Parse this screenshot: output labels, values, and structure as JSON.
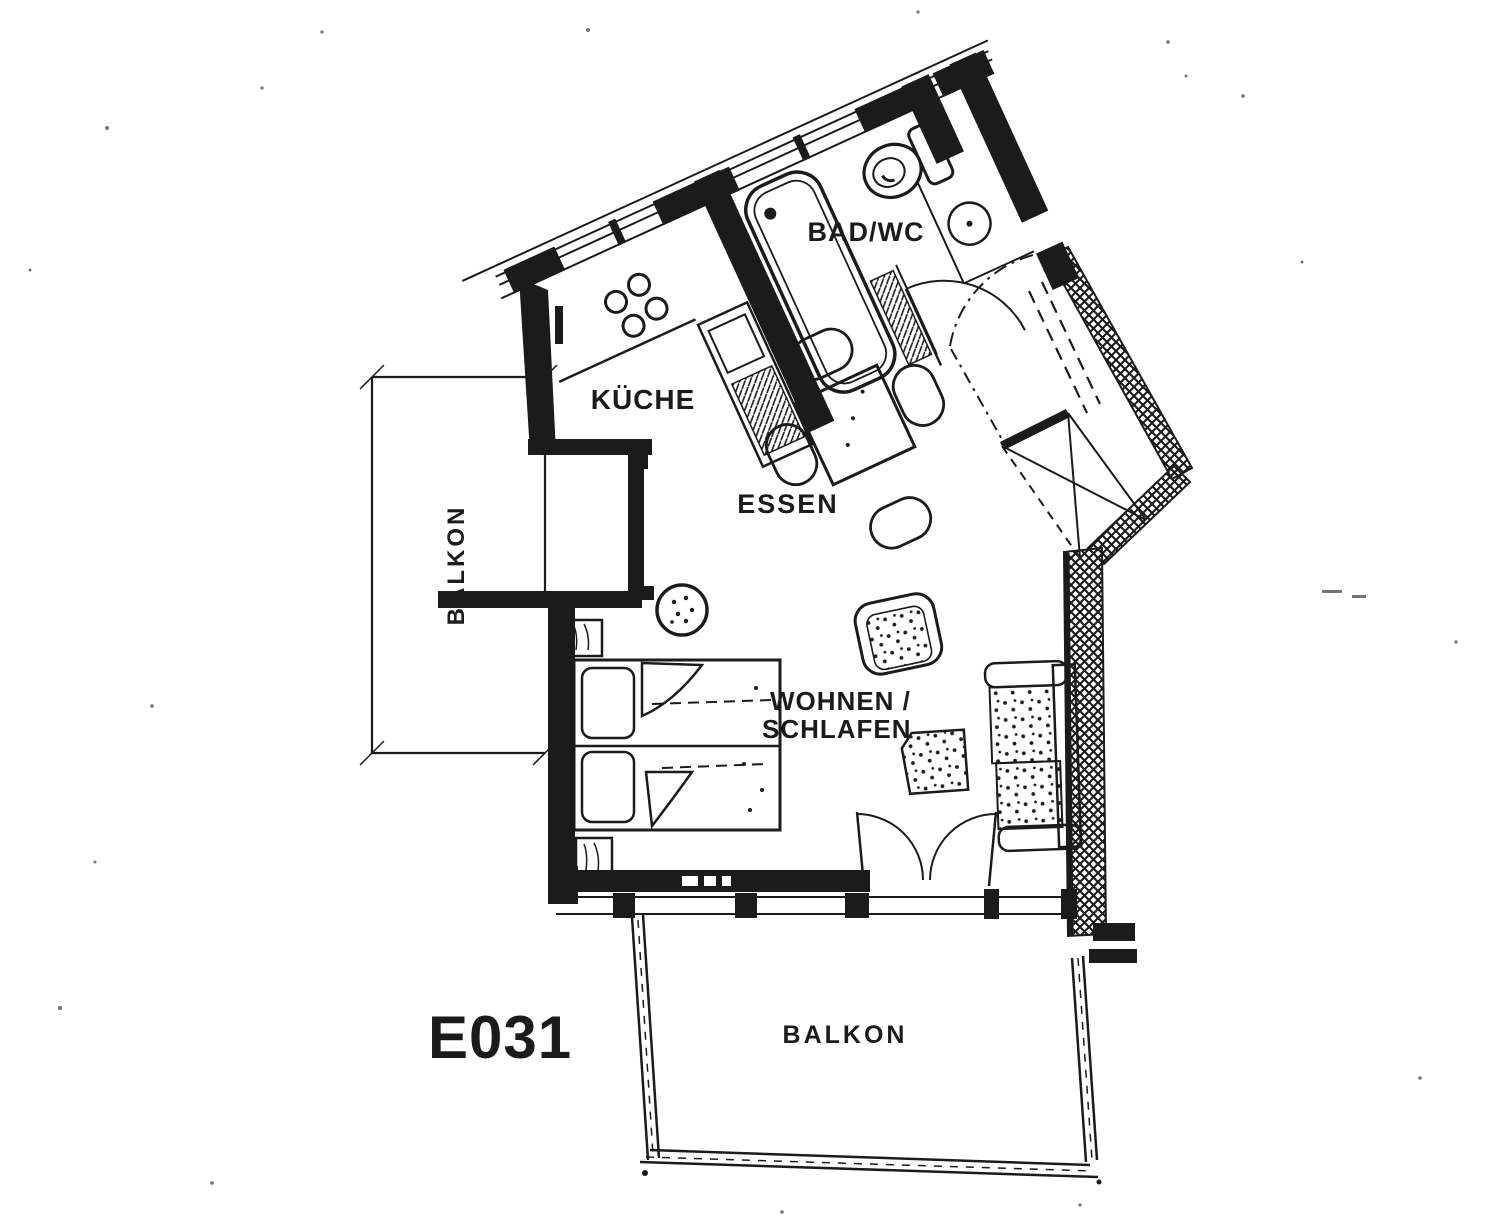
{
  "document": {
    "type": "scanned apartment floor plan",
    "unit_label": "E031"
  },
  "labels": {
    "bad_wc": "BAD/WC",
    "kueche": "KÜCHE",
    "essen": "ESSEN",
    "wohnen_line1": "WOHNEN /",
    "wohnen_line2": "SCHLAFEN",
    "balkon_left": "BALKON",
    "balkon_bottom": "BALKON",
    "unit": "E031"
  },
  "colors": {
    "ink": "#1b1b1b",
    "paper": "#ffffff"
  }
}
